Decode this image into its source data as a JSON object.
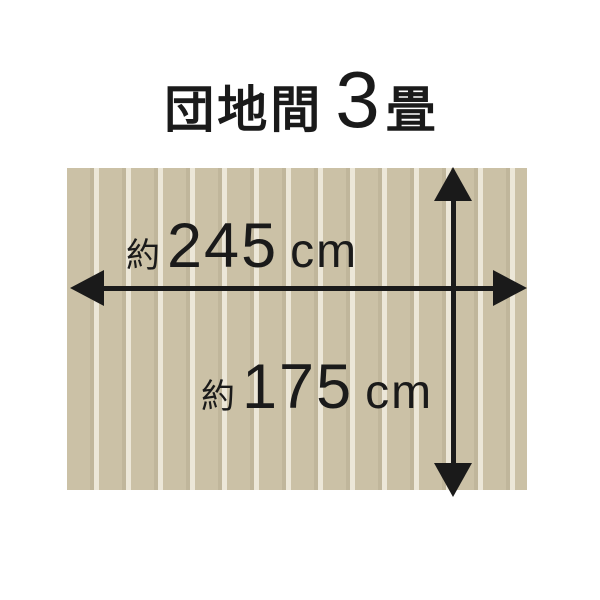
{
  "title": {
    "room_type": "団地間",
    "size_value": "3",
    "size_unit": "畳"
  },
  "dimensions": {
    "width": {
      "prefix": "約",
      "value": "245",
      "unit": "cm"
    },
    "height": {
      "prefix": "約",
      "value": "175",
      "unit": "cm"
    }
  },
  "icons": {
    "width_arrow": "double-headed-horizontal-arrow",
    "height_arrow": "double-headed-vertical-arrow"
  },
  "colors": {
    "background": "#ffffff",
    "ink": "#1a1a1a",
    "floor_base": "#cbc1a6",
    "floor_plank_edge": "#c0b69b",
    "floor_gap": "#ece7d8"
  }
}
